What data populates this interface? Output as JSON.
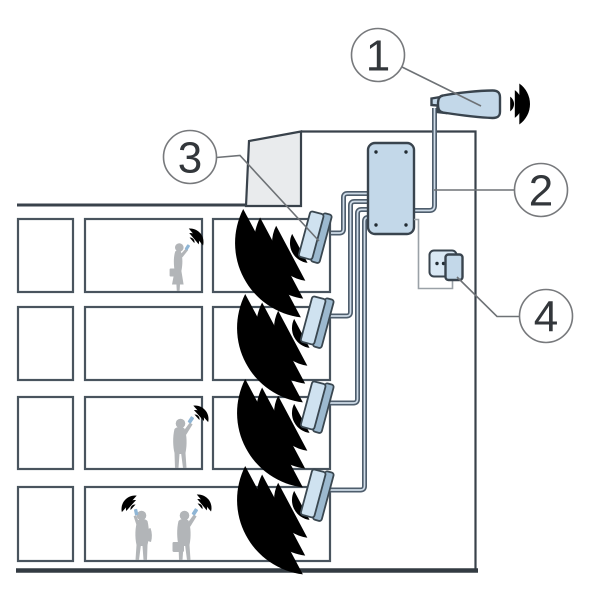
{
  "figure": {
    "type": "technical-diagram",
    "subject": "mobile-signal-booster-system-in-building",
    "callouts": [
      {
        "number": "1",
        "component": "outdoor-donor-antenna"
      },
      {
        "number": "2",
        "component": "coaxial-cable-to-booster"
      },
      {
        "number": "3",
        "component": "indoor-panel-antenna"
      },
      {
        "number": "4",
        "component": "power-outlet-adapter"
      }
    ],
    "components": {
      "booster_box": "signal-booster-amplifier",
      "indoor_antenna_count": 4,
      "people_with_phones": 4,
      "floors": 4
    },
    "colors": {
      "outline": "#39424b",
      "device_fill": "#c3d8e9",
      "device_face": "#cfe2f0",
      "signal_wave": "#bdd7ea",
      "phone_wave": "#8fb9da",
      "structure_gray": "#e9ebed",
      "person_gray": "#b2b5b8",
      "cable_dark": "#4e5d6c",
      "cable_light": "#cfdce8",
      "callout_stroke": "#77797c"
    }
  }
}
